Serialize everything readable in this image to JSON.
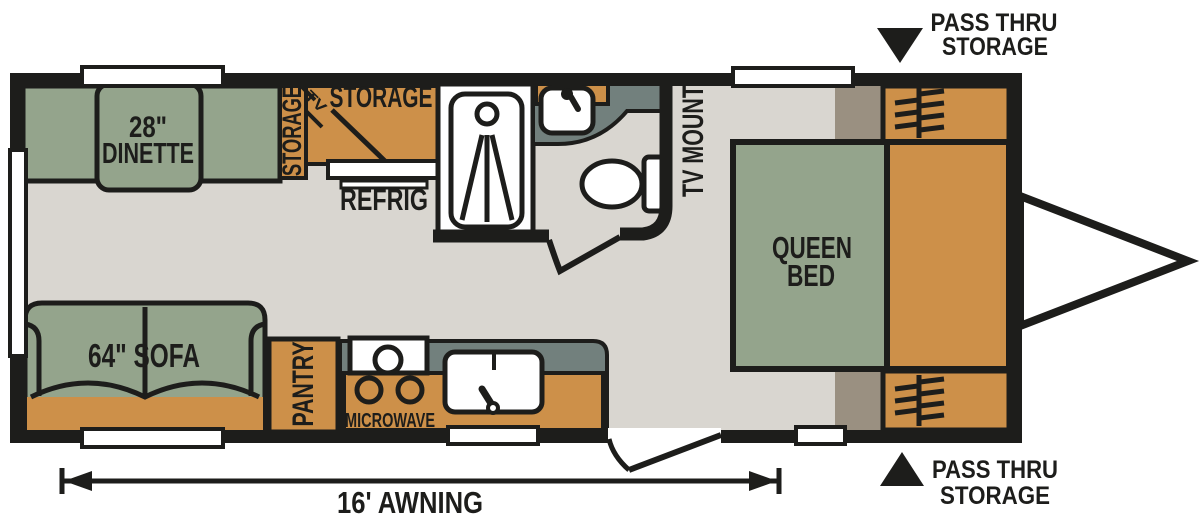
{
  "title": "Travel trailer floor plan",
  "colors": {
    "wall": "#1d1d1b",
    "orange": "#cd9049",
    "green": "#94a48c",
    "floor": "#d9d6d0",
    "counter": "#72807d",
    "taupe": "#9a9081",
    "white": "#ffffff"
  },
  "labels": {
    "dinette_size": "28\"",
    "dinette": "DINETTE",
    "side_storage": "STORAGE",
    "overhead_storage": "STORAGE",
    "tv_corner": "TV",
    "refrigerator": "REFRIG",
    "tv_mount": "TV MOUNT",
    "queen_line1": "QUEEN",
    "queen_line2": "BED",
    "sofa": "64\" SOFA",
    "pantry": "PANTRY",
    "microwave": "MICROWAVE",
    "awning": "16' AWNING",
    "pass_thru_top_line1": "PASS THRU",
    "pass_thru_top_line2": "STORAGE",
    "pass_thru_bottom_line1": "PASS THRU",
    "pass_thru_bottom_line2": "STORAGE"
  },
  "icons": {
    "pass_thru_top_indicator": "filled-triangle-down",
    "pass_thru_bottom_indicator": "filled-triangle-up",
    "wardrobe_symbol": "hanging-rod-with-hangers",
    "hitch_symbol": "tongue-triangle",
    "shower_symbol": "shower-spray",
    "awning_dimension": "double-ended-dimension-arrow"
  }
}
